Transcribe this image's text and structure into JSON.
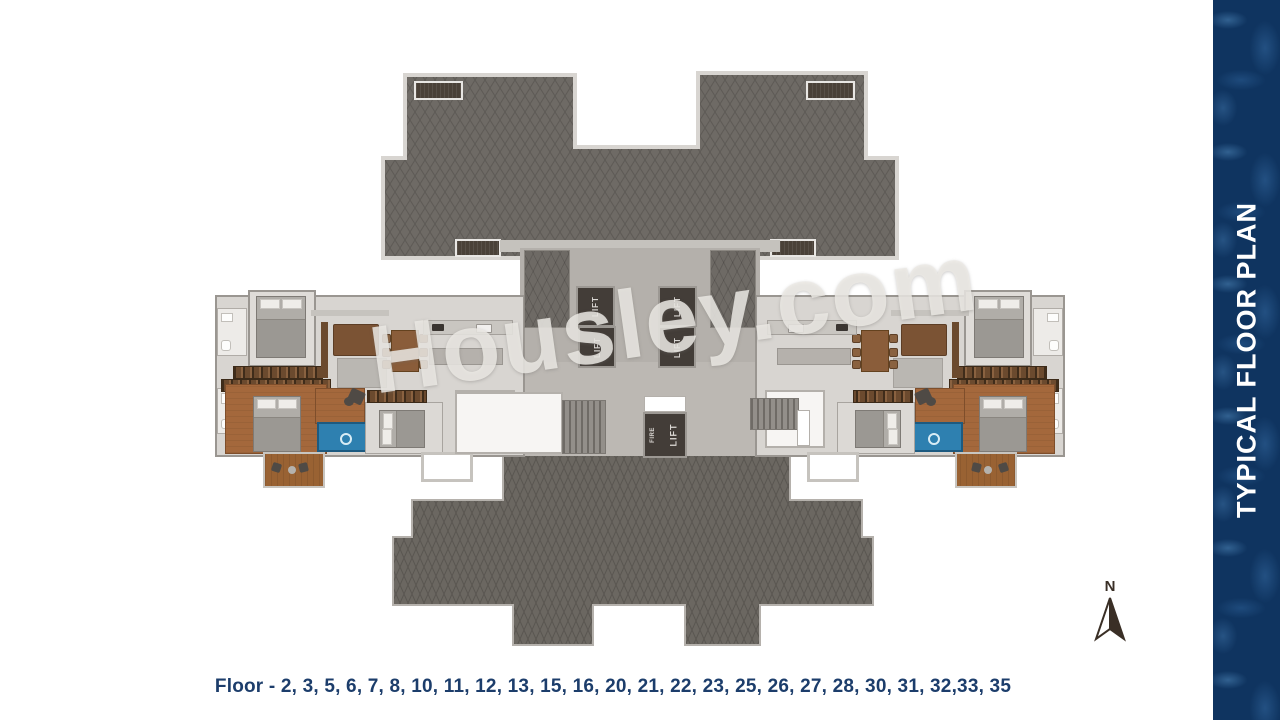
{
  "banner": {
    "title": "TYPICAL FLOOR PLAN",
    "bg_color": "#0f3460",
    "text_color": "#ffffff"
  },
  "caption": {
    "label": "Floor - 2, 3, 5, 6, 7, 8, 10, 11, 12, 13, 15, 16, 20, 21, 22, 23, 25, 26, 27, 28, 30, 31, 32,33, 35",
    "color": "#1c3d6b"
  },
  "watermark": {
    "text": "Housley.com"
  },
  "compass": {
    "north_label": "N"
  },
  "core": {
    "lifts": [
      "LIFT",
      "LIFT",
      "LIFT",
      "LIFT"
    ],
    "fire_lift": {
      "line1": "FIRE",
      "line2": "LIFT"
    }
  },
  "colors": {
    "roof_gray": "#6e6a65",
    "floor_gray": "#d8d5d1",
    "wood_brown": "#a4683c",
    "pool_blue": "#2e80b0",
    "lift_dark": "#433d38",
    "navy": "#1c3d6b"
  }
}
